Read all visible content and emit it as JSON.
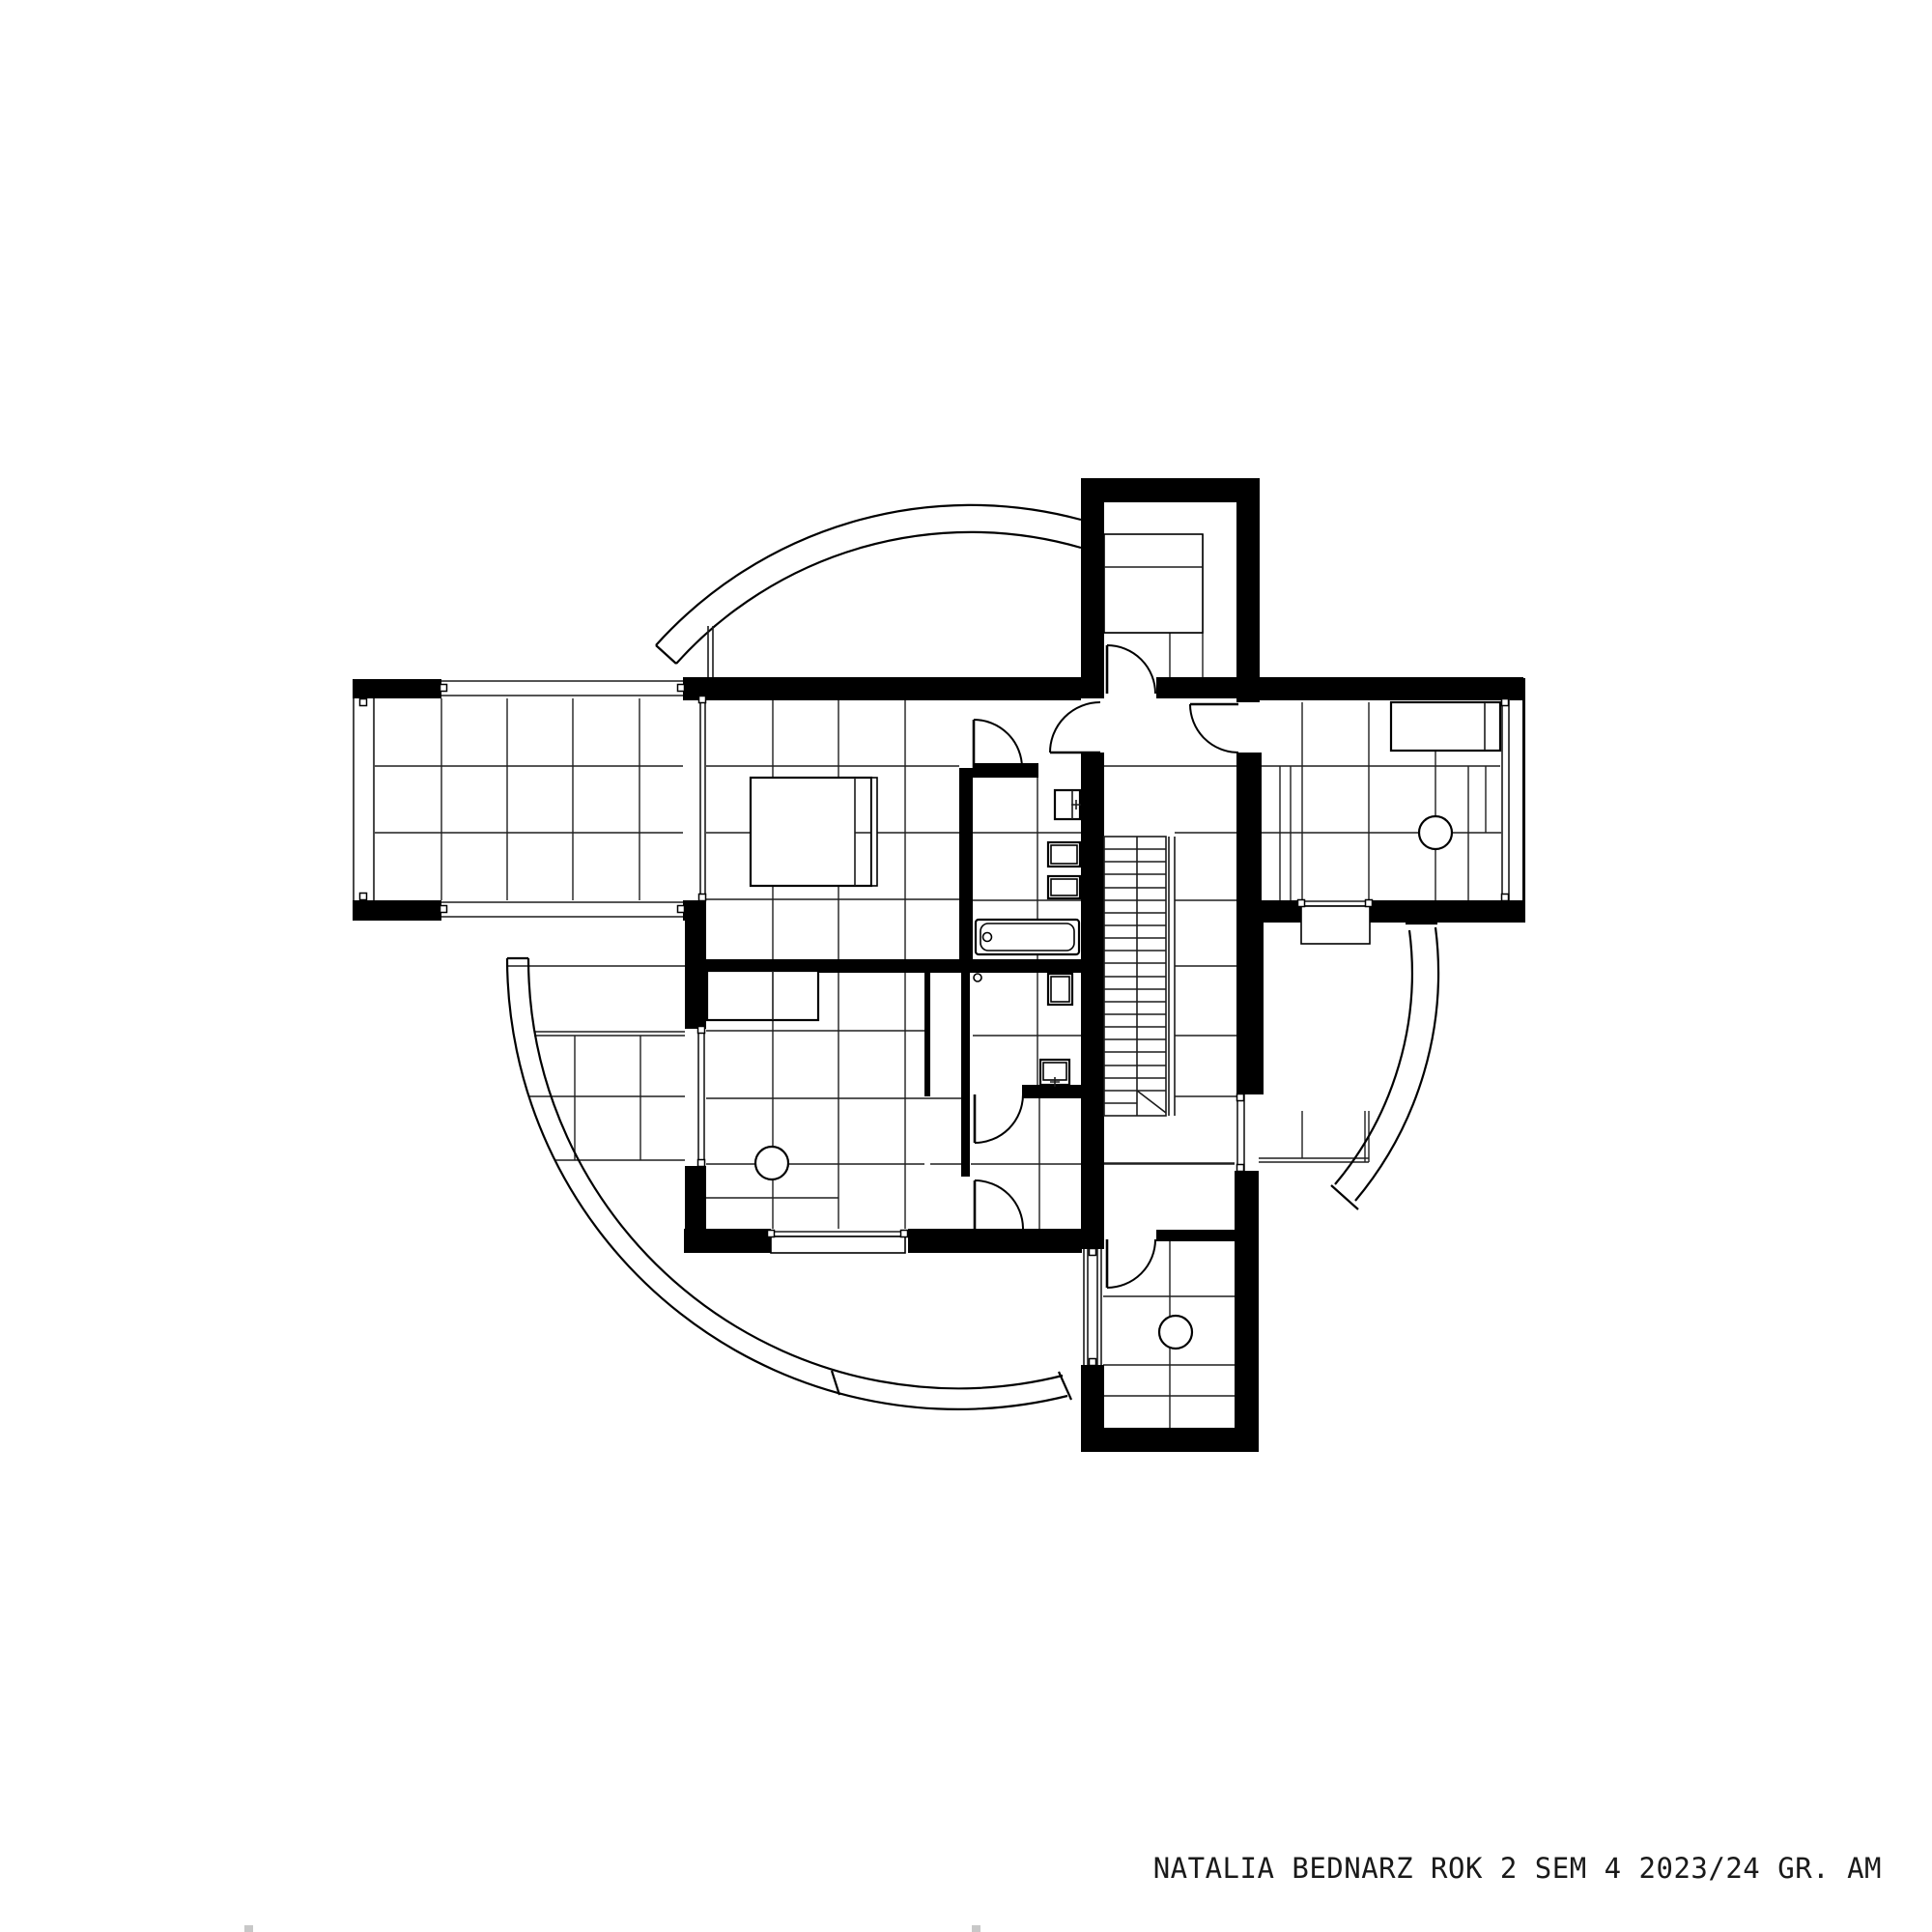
{
  "page": {
    "background": "#ffffff",
    "ink": "#000000",
    "kind": "architectural floor plan drawing, upper storey"
  },
  "title_block": {
    "text": "NATALIA BEDNARZ ROK 2 SEM 4 2023/24 GR. AM"
  }
}
